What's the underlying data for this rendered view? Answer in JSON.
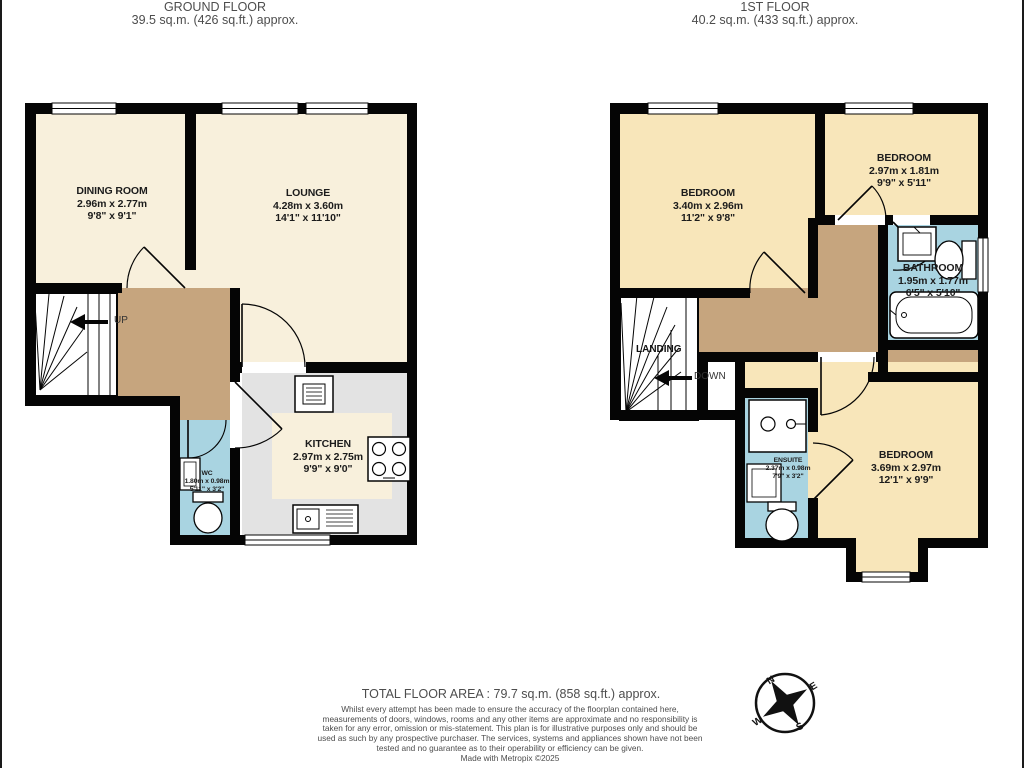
{
  "headers": {
    "ground": {
      "title": "GROUND FLOOR",
      "area": "39.5 sq.m. (426 sq.ft.) approx."
    },
    "first": {
      "title": "1ST FLOOR",
      "area": "40.2 sq.m. (433 sq.ft.) approx."
    }
  },
  "ground_floor": {
    "rooms": {
      "dining": {
        "name": "DINING ROOM",
        "metric": "2.96m x 2.77m",
        "imperial": "9'8\" x 9'1\""
      },
      "lounge": {
        "name": "LOUNGE",
        "metric": "4.28m x 3.60m",
        "imperial": "14'1\" x 11'10\""
      },
      "kitchen": {
        "name": "KITCHEN",
        "metric": "2.97m x 2.75m",
        "imperial": "9'9\" x 9'0\""
      },
      "wc": {
        "name": "WC",
        "metric": "1.80m x 0.98m",
        "imperial": "5'11\" x 3'2\""
      }
    },
    "stair_label": "UP"
  },
  "first_floor": {
    "rooms": {
      "bedroom1": {
        "name": "BEDROOM",
        "metric": "3.40m x 2.96m",
        "imperial": "11'2\" x 9'8\""
      },
      "bedroom2": {
        "name": "BEDROOM",
        "metric": "2.97m x 1.81m",
        "imperial": "9'9\" x 5'11\""
      },
      "bathroom": {
        "name": "BATHROOM",
        "metric": "1.95m x 1.77m",
        "imperial": "6'5\" x 5'10\""
      },
      "ensuite": {
        "name": "ENSUITE",
        "metric": "2.37m x 0.98m",
        "imperial": "7'9\" x 3'2\""
      },
      "bedroom3": {
        "name": "BEDROOM",
        "metric": "3.69m x 2.97m",
        "imperial": "12'1\" x 9'9\""
      }
    },
    "landing_label": "LANDING",
    "stair_label": "DOWN"
  },
  "footer": {
    "total_area": "TOTAL FLOOR AREA : 79.7 sq.m. (858 sq.ft.) approx.",
    "disclaimer": "Whilst every attempt has been made to ensure the accuracy of the floorplan contained here, measurements of doors, windows, rooms and any other items are approximate and no responsibility is taken for any error, omission or mis-statement. This plan is for illustrative purposes only and should be used as such by any prospective purchaser. The services, systems and appliances shown have not been tested and no guarantee as to their operability or efficiency can be given.",
    "credit": "Made with Metropix ©2025"
  },
  "compass": {
    "north": "N",
    "east": "E",
    "south": "S",
    "west": "W"
  },
  "colors": {
    "wall": "#050505",
    "room_cream": "#f8f0dc",
    "room_yellow": "#f8e6ba",
    "hall_brown": "#c6a57e",
    "bath_blue": "#a9d4e1",
    "kitchen_grey": "#e3e3e3"
  }
}
